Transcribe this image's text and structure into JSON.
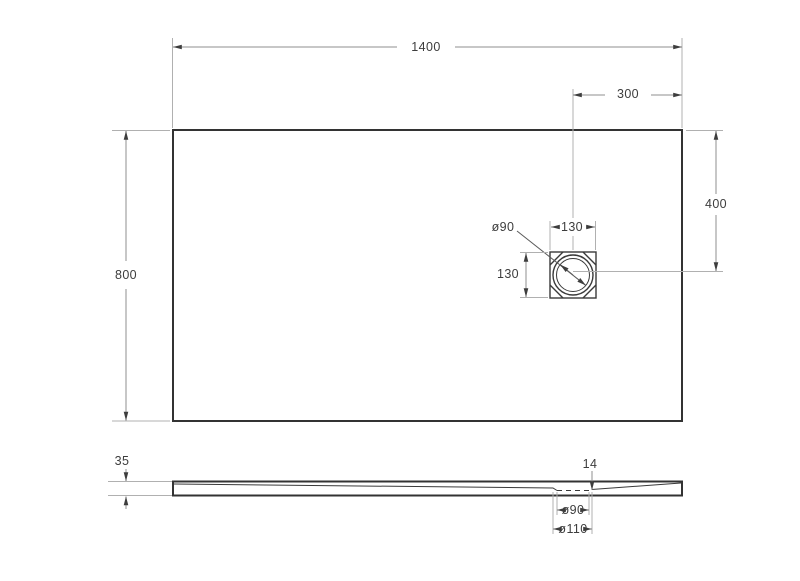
{
  "drawing": {
    "colors": {
      "outline": "#333333",
      "dimension_line": "#8f8f8f",
      "extension_line": "#b0b0b0",
      "text": "#3d3d3d",
      "background": "#ffffff"
    },
    "top_view": {
      "overall_width_mm": "1400",
      "overall_depth_mm": "800",
      "drain_offset_from_right_mm": "300",
      "drain_offset_from_top_mm": "400",
      "drain_flange_width_mm": "130",
      "drain_flange_height_mm": "130",
      "drain_hole_diameter": "ø90"
    },
    "side_view": {
      "edge_height_mm": "35",
      "drain_depth_mm": "14",
      "drain_hole_diameter": "ø90",
      "drain_recess_diameter": "ø110"
    }
  }
}
